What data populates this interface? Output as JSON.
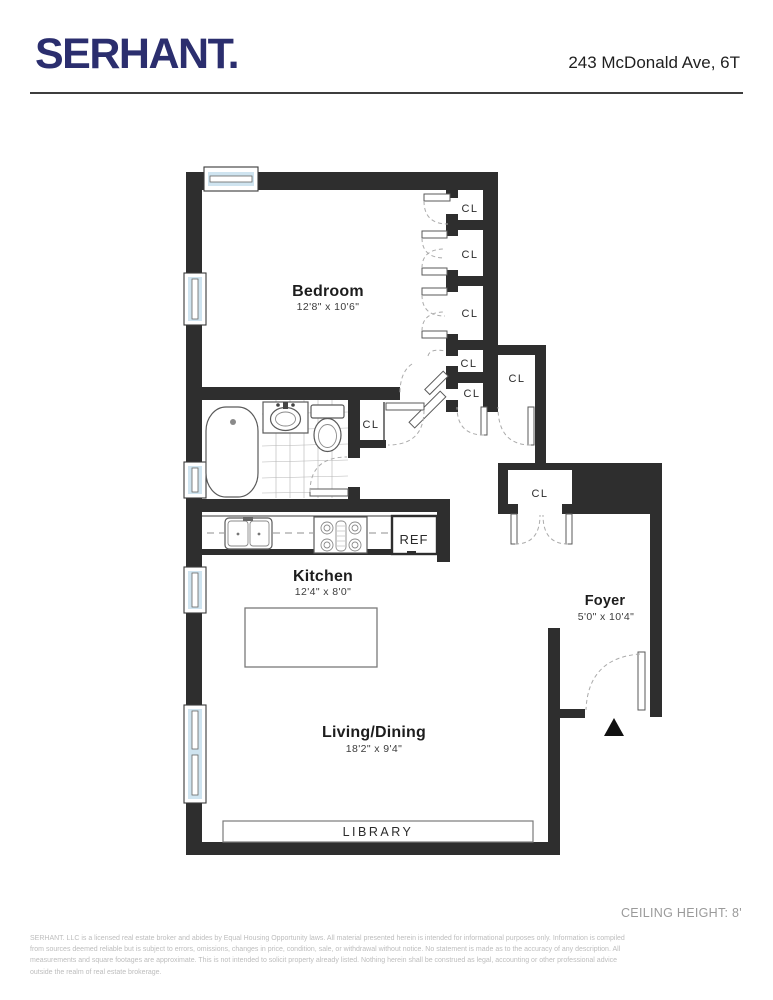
{
  "header": {
    "logo": "SERHANT.",
    "address": "243 McDonald Ave, 6T"
  },
  "rooms": {
    "bedroom": {
      "name": "Bedroom",
      "dims": "12'8\" x 10'6\""
    },
    "kitchen": {
      "name": "Kitchen",
      "dims": "12'4\" x 8'0\""
    },
    "living": {
      "name": "Living/Dining",
      "dims": "18'2\" x 9'4\""
    },
    "foyer": {
      "name": "Foyer",
      "dims": "5'0\" x 10'4\""
    }
  },
  "labels": {
    "closet": "CL",
    "fridge": "REF",
    "library": "LIBRARY"
  },
  "footer": {
    "ceiling_height": "CEILING HEIGHT: 8'",
    "disclaimer_line1": "SERHANT. LLC is a licensed real estate broker and abides by Equal Housing Opportunity laws. All material presented herein is intended for informational purposes only. Information is compiled",
    "disclaimer_line2": "from sources deemed reliable but is subject to errors, omissions, changes in price, condition, sale, or withdrawal without notice. No statement is made as to the accuracy of any description. All",
    "disclaimer_line3": "measurements and square footages are approximate. This is not intended to solicit property already listed. Nothing herein shall be construed as legal, accounting or other professional advice",
    "disclaimer_line4": "outside the realm of real estate brokerage."
  },
  "colors": {
    "wall": "#2e2e2e",
    "window_glass": "#cfe4f0",
    "brand_navy": "#2b2e6e",
    "label_dark": "#1d1d1d",
    "footer_gray": "#9a9a9a",
    "disclaimer_gray": "#bdbdbd"
  }
}
